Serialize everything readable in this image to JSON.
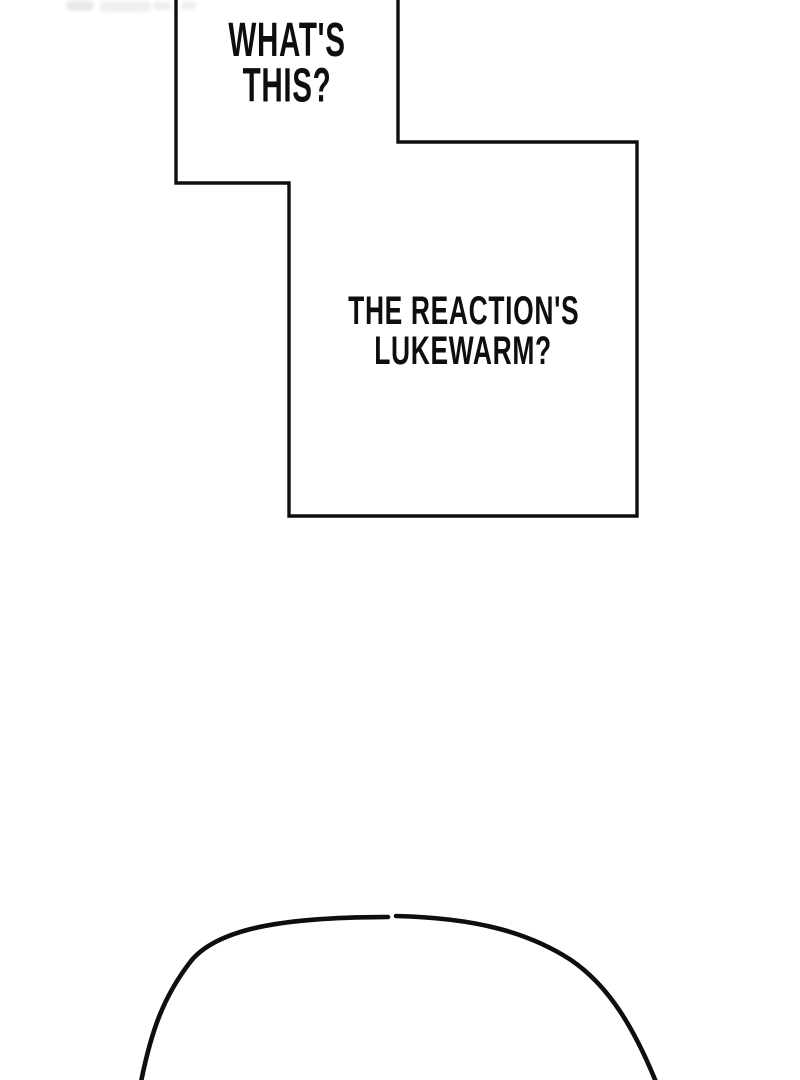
{
  "panel": {
    "background": "#ffffff",
    "ink": "#0e0e0e",
    "smudge_color": "#eeeeee"
  },
  "speech_bubbles": [
    {
      "lines": [
        "WHAT'S",
        "THIS?"
      ]
    },
    {
      "lines": [
        "THE REACTION'S",
        "LUKEWARM?"
      ]
    }
  ]
}
